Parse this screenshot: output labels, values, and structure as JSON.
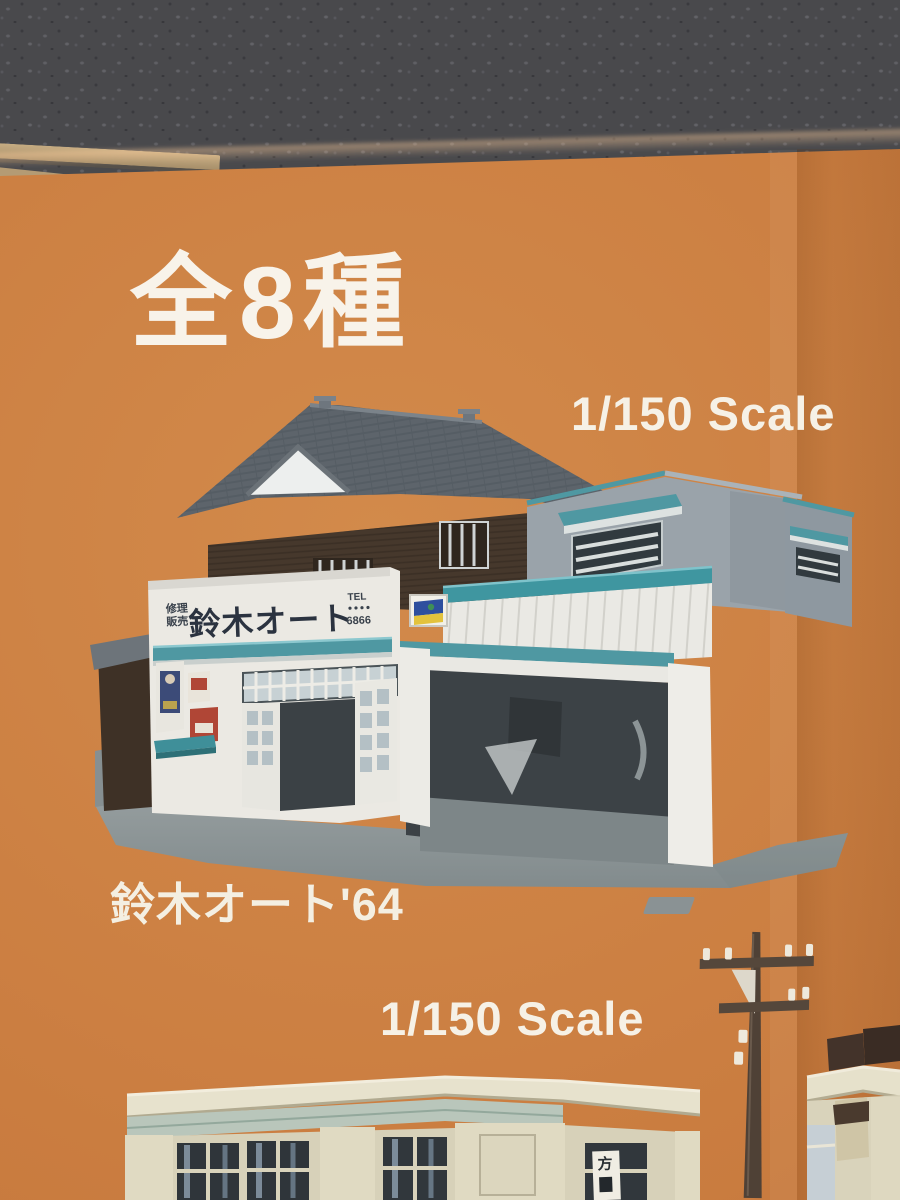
{
  "box_front": {
    "series_label": "全8種",
    "scale_label_top": "1/150 Scale",
    "model_caption": "鈴木オート'64",
    "scale_label_bottom": "1/150 Scale"
  },
  "model_photo": {
    "storefront": {
      "sign_main": "鈴木オート",
      "sign_left_top": "修理",
      "sign_left_bottom": "販売",
      "tel_label": "TEL",
      "tel_number": "6866"
    },
    "street_sign_character": "方"
  },
  "colors": {
    "box_orange": "#cb7e41",
    "leather_background": "#4a4a4d",
    "label_white": "#f6f1e6",
    "awning_teal": "#4f98a2",
    "sign_text_navy": "#2b3340",
    "house_wall_brown": "#46382c",
    "roof_gray": "#5d646b",
    "garage_gray": "#9aa3aa",
    "bank_cream": "#d7d1b9"
  }
}
